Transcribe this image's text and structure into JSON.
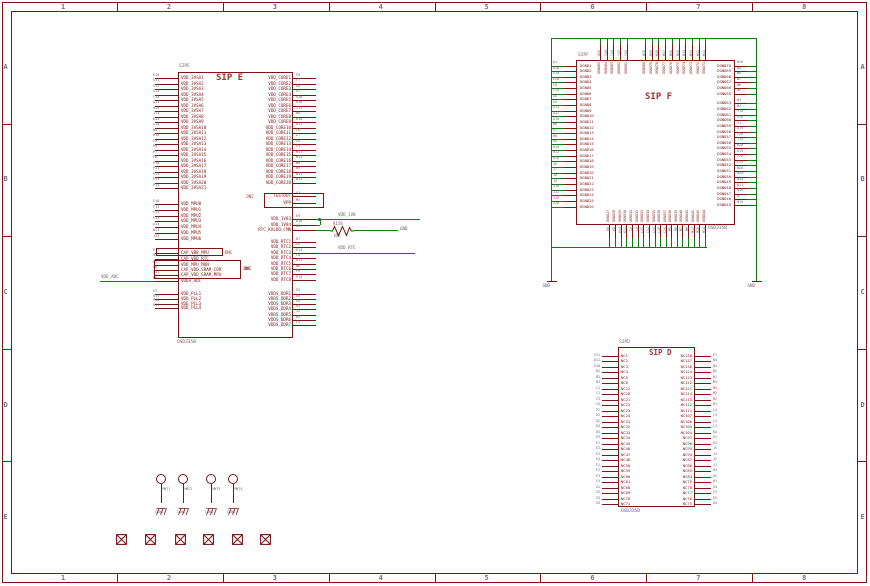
{
  "frame": {
    "cols": [
      "1",
      "2",
      "3",
      "4",
      "5",
      "6",
      "7",
      "8"
    ],
    "rows": [
      "A",
      "B",
      "C",
      "D",
      "E"
    ]
  },
  "sip_e": {
    "header": "SIPE",
    "title": "SIP E",
    "value": "OSD335B",
    "dnc": "DNC",
    "left_groups": [
      {
        "labels": [
          "VDD_3VSA1",
          "VDD_3VSA2",
          "VDD_3VSA3",
          "VDD_3VSA4",
          "VDD_3VSA5",
          "VDD_3VSA6",
          "VDD_3VSA7",
          "VDD_3VSA8",
          "VDD_3VSA9",
          "VDD_3VSA10",
          "VDD_3VSA11",
          "VDD_3VSA12",
          "VDD_3VSA13",
          "VDD_3VSA14",
          "VDD_3VSA15",
          "VDD_3VSA16",
          "VDD_3VSA17",
          "VDD_3VSA18",
          "VDD_3VSA19",
          "VDD_3VSA20",
          "VDD_3VSA21"
        ],
        "nums": [
          "E10",
          "E11",
          "G12",
          "G13",
          "F14",
          "G14",
          "H14",
          "J13",
          "K13",
          "L14",
          "N5",
          "M15",
          "P5",
          "P6",
          "P7",
          "P8",
          "P10",
          "P11",
          "P12",
          "P13",
          "P15"
        ]
      },
      {
        "labels": [
          "VDD_MPU0",
          "VDD_MPU1",
          "VDD_MPU2",
          "VDD_MPU3",
          "VDD_MPU4",
          "VDD_MPU5",
          "VDD_MPU6"
        ],
        "nums": [
          "F10",
          "F11",
          "F12",
          "F13",
          "G13",
          "H13",
          "J13"
        ]
      },
      {
        "labels": [
          "CAP_VBB_MPU",
          "CAP_VDD_RTC"
        ],
        "nums": [
          "E12",
          "D4"
        ]
      },
      {
        "labels": [
          "VDD_MPU_MON",
          "CAP_VDD_SRAM_COR",
          "CAP_VDD_SRAM_MPU"
        ],
        "nums": [
          "A2",
          "D8",
          "D11"
        ]
      },
      {
        "labels": [
          "VDDA_ADC"
        ],
        "nums": [
          "B6"
        ]
      },
      {
        "labels": [
          "VDD_PLL1",
          "VDD_PLL2",
          "VDD_PLL3",
          "VDD_PLL4"
        ],
        "nums": [
          "E7",
          "H15",
          "P16",
          "R11"
        ]
      }
    ],
    "right_groups": [
      {
        "labels": [
          "VDD_CORE1",
          "VDD_CORE2",
          "VDD_CORE3",
          "VDD_CORE4",
          "VDD_CORE5",
          "VDD_CORE6",
          "VDD_CORE7",
          "VDD_CORE8",
          "VDD_CORE9",
          "VDD_CORE10",
          "VDD_CORE11",
          "VDD_CORE12",
          "VDD_CORE13",
          "VDD_CORE14",
          "VDD_CORE15",
          "VDD_CORE16",
          "VDD_CORE17",
          "VDD_CORE18",
          "VDD_CORE19",
          "VDD_CORE20"
        ],
        "nums": [
          "F6",
          "F7",
          "G6",
          "G7",
          "G10",
          "H10",
          "J12",
          "K6",
          "K10",
          "K12",
          "L6",
          "L7",
          "L8",
          "L9",
          "M11",
          "M13",
          "N8",
          "N9",
          "N12",
          "N13"
        ]
      },
      {
        "labels": [
          "TESTOUT",
          "VPP"
        ],
        "nums": [
          "A3",
          "M5"
        ]
      },
      {
        "labels": [
          "VDD_1V83",
          "VDD_1V84"
        ],
        "nums": [
          "E9",
          "D10"
        ]
      },
      {
        "labels": [
          "RTC_KALDO_CMN"
        ],
        "nums": [
          "B4"
        ]
      },
      {
        "labels": [
          "VDD_RTC1",
          "VDD_RTC2",
          "VDD_RTC3",
          "VDD_RTC4",
          "VDD_RTC5",
          "VDD_RTC6",
          "VDD_RTC7",
          "VDD_RTC8"
        ],
        "nums": [
          "D7",
          "E8",
          "E14",
          "F8",
          "K13",
          "N6",
          "P9",
          "P14"
        ]
      },
      {
        "labels": [
          "VDDS_DDR1",
          "VDDS_DDR2",
          "VDDS_DDR3",
          "VDDS_DDR4",
          "VDDS_DDR5",
          "VDDS_DDR6",
          "VDDS_DDR7"
        ],
        "nums": [
          "E5",
          "E6",
          "G5",
          "H5",
          "J5",
          "K5",
          "L5"
        ]
      }
    ],
    "nets": {
      "vdd_adc": "VDD_ADC",
      "vdd_1v8": "VDD_1V8",
      "gnd": "GND",
      "vdd_rtc": "VDD_RTC"
    },
    "resistor": {
      "name": "R158",
      "value": "10K"
    }
  },
  "sip_f": {
    "header": "SIPF",
    "title": "SIP F",
    "value": "OSD335B",
    "gnd_label": "GND",
    "left": {
      "labels": [
        "DGND1",
        "DGND2",
        "DGND3",
        "DGND4",
        "DGND5",
        "DGND6",
        "DGND7",
        "DGND8",
        "DGND9",
        "DGND10",
        "DGND11",
        "DGND12",
        "DGND13",
        "DGND14",
        "DGND15",
        "DGND16",
        "DGND17",
        "DGND18",
        "DGND19",
        "DGND20",
        "DGND21",
        "DGND22",
        "DGND23",
        "DGND24",
        "DGND25",
        "DGND26"
      ],
      "nums": [
        "A1",
        "A16",
        "E19",
        "E20",
        "F8",
        "F19",
        "G8",
        "G9",
        "G11",
        "G12",
        "G19",
        "H6",
        "H7",
        "H8",
        "H9",
        "H10",
        "H12",
        "H19",
        "J6",
        "J7",
        "J8",
        "J9",
        "J10",
        "J11",
        "J19",
        "J20"
      ]
    },
    "right_a": {
      "labels": [
        "DGND70",
        "DGND69",
        "DGND68",
        "DGND67",
        "DGND66",
        "DGND65"
      ],
      "nums": [
        "W10",
        "W9",
        "W8",
        "W7",
        "W6",
        "W5"
      ]
    },
    "right_b": {
      "labels": [
        "DGND63",
        "DGND62",
        "DGND61",
        "DGND60",
        "DGND59",
        "DGND58",
        "DGND57",
        "DGND56",
        "DGND55",
        "DGND54",
        "DGND53",
        "DGND52",
        "DGND51",
        "DGND50",
        "DGND49",
        "DGND48",
        "DGND47",
        "DGND46",
        "DGND45"
      ],
      "nums": [
        "W3",
        "W2",
        "V19",
        "V18",
        "V1",
        "U19",
        "T20",
        "T19",
        "R20",
        "R19",
        "P20",
        "P19",
        "N20",
        "N19",
        "N14",
        "N11",
        "N10",
        "R7",
        "M19"
      ]
    },
    "top_a": {
      "labels": [
        "DGND85",
        "DGND84",
        "DGND83",
        "DGND82",
        "DGND81"
      ],
      "nums": [
        "U20",
        "Y20",
        "Y19",
        "Y17",
        "Y15"
      ]
    },
    "top_b": {
      "labels": [
        "DGND80",
        "DGND79",
        "DGND78",
        "DGND77",
        "DGND76",
        "DGND75",
        "DGND74",
        "DGND73",
        "DGND72",
        "DGND71"
      ],
      "nums": [
        "W20",
        "W19",
        "W18",
        "W17",
        "W16",
        "W15",
        "W14",
        "W13",
        "W12",
        "W11"
      ]
    },
    "bottom_a": {
      "labels": [
        "DGND27",
        "DGND28",
        "DGND29",
        "DGND30",
        "DGND31",
        "DGND32",
        "DGND33",
        "DGND34",
        "DGND35",
        "DGND36",
        "DGND37"
      ],
      "nums": [
        "K6",
        "K8",
        "K19",
        "K11",
        "L6",
        "L8",
        "L11",
        "L12",
        "L13",
        "L19",
        "L20"
      ]
    },
    "bottom_b": {
      "labels": [
        "DGND38",
        "DGND39",
        "DGND40",
        "DGND41",
        "DGND42",
        "DGND43",
        "DGND44"
      ],
      "nums": [
        "M5",
        "M6",
        "M7",
        "M8",
        "M13",
        "M20",
        "M14"
      ]
    }
  },
  "sip_d": {
    "header": "SIPD",
    "title": "SIP D",
    "value": "OSD335B",
    "left": {
      "labels": [
        "NC1",
        "NC2",
        "NC3",
        "NC4",
        "NC5",
        "NC6",
        "NC12",
        "NC20",
        "NC21",
        "NC22",
        "NC23",
        "NC24",
        "NC31",
        "NC32",
        "NC33",
        "NC34",
        "NC45",
        "NC46",
        "NC47",
        "NC48",
        "NC58",
        "NC59",
        "NC60",
        "NC61",
        "NC68",
        "NC69",
        "NC70",
        "NC71"
      ],
      "nums": [
        "V11",
        "U11",
        "V10",
        "B1",
        "B2",
        "B3",
        "C1",
        "C2",
        "C3",
        "C4",
        "P2",
        "D1",
        "D2",
        "D3",
        "D5",
        "P3",
        "E1",
        "E2",
        "E3",
        "E4",
        "F1",
        "F2",
        "F3",
        "F4",
        "G1",
        "G2",
        "G3",
        "G5"
      ]
    },
    "right": {
      "labels": [
        "NC138",
        "NC137",
        "NC136",
        "NC124",
        "NC123",
        "NC122",
        "NC121",
        "NC114",
        "NC113",
        "NC112",
        "NC111",
        "NC107",
        "NC106",
        "NC105",
        "NC104",
        "NC97",
        "NC96",
        "NC95",
        "NC94",
        "NC87",
        "NC86",
        "NC85",
        "NC84",
        "NC79",
        "NC78",
        "NC77",
        "NC76",
        "NC75"
      ],
      "nums": [
        "P1",
        "N4",
        "N5",
        "N2",
        "N1",
        "M5",
        "M4",
        "M3",
        "M2",
        "M1",
        "L4",
        "L5",
        "L2",
        "L1",
        "K4",
        "K1",
        "K2",
        "J5",
        "J4",
        "J2",
        "J1",
        "H4",
        "H2",
        "H1",
        "G4",
        "F5",
        "E5",
        "D4"
      ]
    }
  },
  "mounting": {
    "labels": [
      "MNT1",
      "MNT2",
      "MNT3",
      "MNT4"
    ],
    "gnd_label": "CGND"
  },
  "fiducials": {
    "count": 6
  }
}
